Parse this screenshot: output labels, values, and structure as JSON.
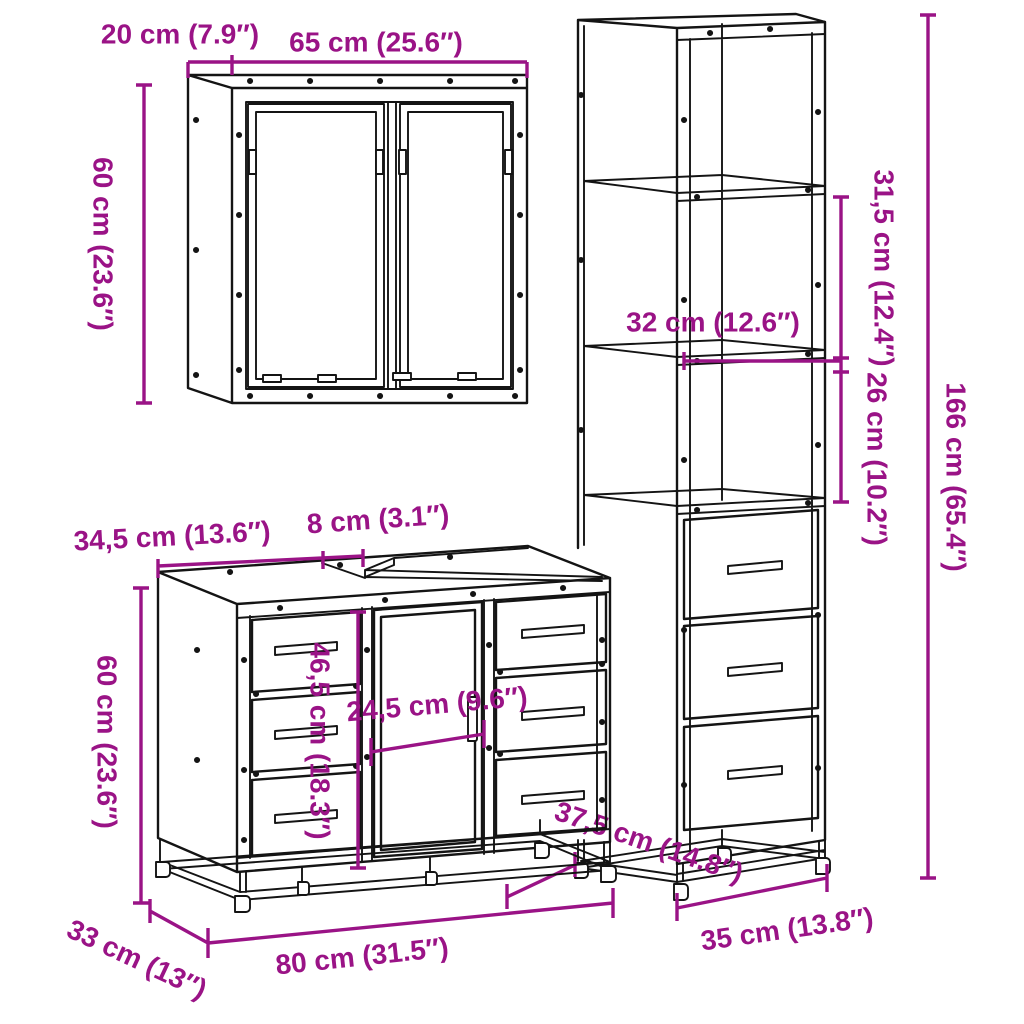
{
  "colors": {
    "dimension_text": "#9A1386",
    "line": "#141414",
    "background": "#FFFFFF"
  },
  "pieces": {
    "wall_cabinet": {
      "name": "mirror wall cabinet",
      "width": "65 cm (25.6″)",
      "depth": "20 cm (7.9″)",
      "height": "60 cm (23.6″)"
    },
    "tall_cabinet": {
      "name": "tall storage cabinet",
      "height": "166 cm (65.4″)",
      "upper_section": "31,5 cm (12.4″)",
      "lower_section": "26 cm (10.2″)",
      "shelf_width": "32 cm (12.6″)",
      "width": "35 cm (13.8″)",
      "depth": "37,5 cm (14.8″)"
    },
    "vanity_cabinet": {
      "name": "sink vanity cabinet",
      "width": "80 cm (31.5″)",
      "depth": "33 cm (13″)",
      "height": "60 cm (23.6″)",
      "drawer_column_height": "46,5 cm (18.3″)",
      "door_width": "24,5 cm (9.6″)",
      "top_left_section": "34,5 cm (13.6″)",
      "top_gap": "8 cm (3.1″)"
    }
  }
}
